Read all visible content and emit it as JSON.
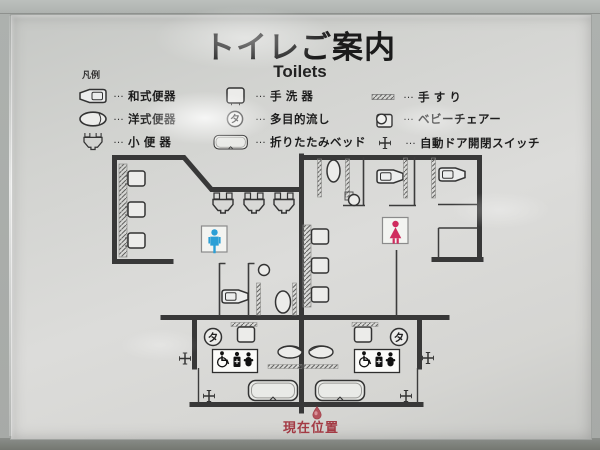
{
  "sign": {
    "title": "トイレご案内",
    "subtitle": "Toilets",
    "legend": {
      "caption": "凡例",
      "leader": "…",
      "items": [
        {
          "name": "squat-toilet",
          "label": "和式便器"
        },
        {
          "name": "western-toilet",
          "label": "洋式便器"
        },
        {
          "name": "urinal",
          "label": "小 便 器"
        },
        {
          "name": "hand-washing-basin",
          "label": "手 洗 器"
        },
        {
          "name": "multipurpose-sink",
          "label": "多目的流し",
          "symbol": "タ"
        },
        {
          "name": "folding-bed",
          "label": "折りたたみベッド"
        },
        {
          "name": "handrail",
          "label": "手 す り"
        },
        {
          "name": "baby-chair",
          "label": "ベビーチェアー"
        },
        {
          "name": "auto-door-switch",
          "label": "自動ドア開閉スイッチ"
        }
      ]
    },
    "map": {
      "multipurpose_sink_symbol": "タ",
      "current_location_label": "現在位置"
    },
    "colors": {
      "wall": "#383838",
      "male_blue": "#2b9fd6",
      "female_pink": "#cf2b5e",
      "location_red": "#a33a44"
    }
  }
}
